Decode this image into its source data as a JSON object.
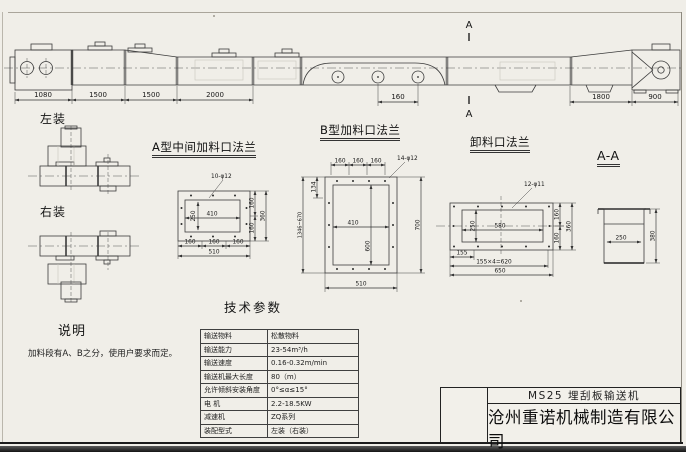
{
  "title_block": {
    "model": "MS25 埋刮板输送机",
    "company": "沧州重诺机械制造有限公司"
  },
  "side_view": {
    "section_letter": "A",
    "dims": {
      "seg1": "1080",
      "seg2": "1500",
      "seg3": "1500",
      "seg4": "2000",
      "mid": "160",
      "seg5": "1800",
      "seg6": "900"
    }
  },
  "mount_labels": {
    "left": "左装",
    "right": "右装"
  },
  "notes": {
    "title": "说明",
    "text": "加料段有A、B之分，使用户要求而定。"
  },
  "flange_a": {
    "title": "A型中间加料口法兰",
    "holes_note": "10-φ12",
    "inner_h": "250",
    "inner_w": "410",
    "right": [
      "160",
      "160",
      "360"
    ],
    "bottom": [
      "160",
      "160",
      "160",
      "510"
    ]
  },
  "flange_b": {
    "title": "B型加料口法兰",
    "holes_note": "14-φ12",
    "top": [
      "160",
      "160",
      "160"
    ],
    "left": [
      "134",
      "1346~670"
    ],
    "inner_w": "410",
    "inner_h": "600",
    "right_total": "700",
    "bottom_total": "510"
  },
  "flange_unload": {
    "title": "卸料口法兰",
    "holes_note": "12-φ11",
    "inner_h": "250",
    "inner_w": "580",
    "right": [
      "160",
      "160",
      "360"
    ],
    "bottom": [
      "155",
      "155×4=620",
      "650"
    ]
  },
  "section_aa": {
    "title": "A-A",
    "inner_w": "250",
    "height": "380"
  },
  "tech": {
    "title": "技术参数",
    "rows": [
      {
        "label": "输送物料",
        "value": "松散物料"
      },
      {
        "label": "输送能力",
        "value": "23-54m³/h"
      },
      {
        "label": "输送速度",
        "value": "0.16-0.32m/min"
      },
      {
        "label": "输送机最大长度",
        "value": "80（m）"
      },
      {
        "label": "允许倾斜安装角度",
        "value": "0°≤α≤15°"
      },
      {
        "label": "电  机",
        "value": "2.2-18.5KW"
      },
      {
        "label": "减速机",
        "value": "ZQ系列"
      },
      {
        "label": "装配型式",
        "value": "左装（右装）"
      }
    ]
  }
}
